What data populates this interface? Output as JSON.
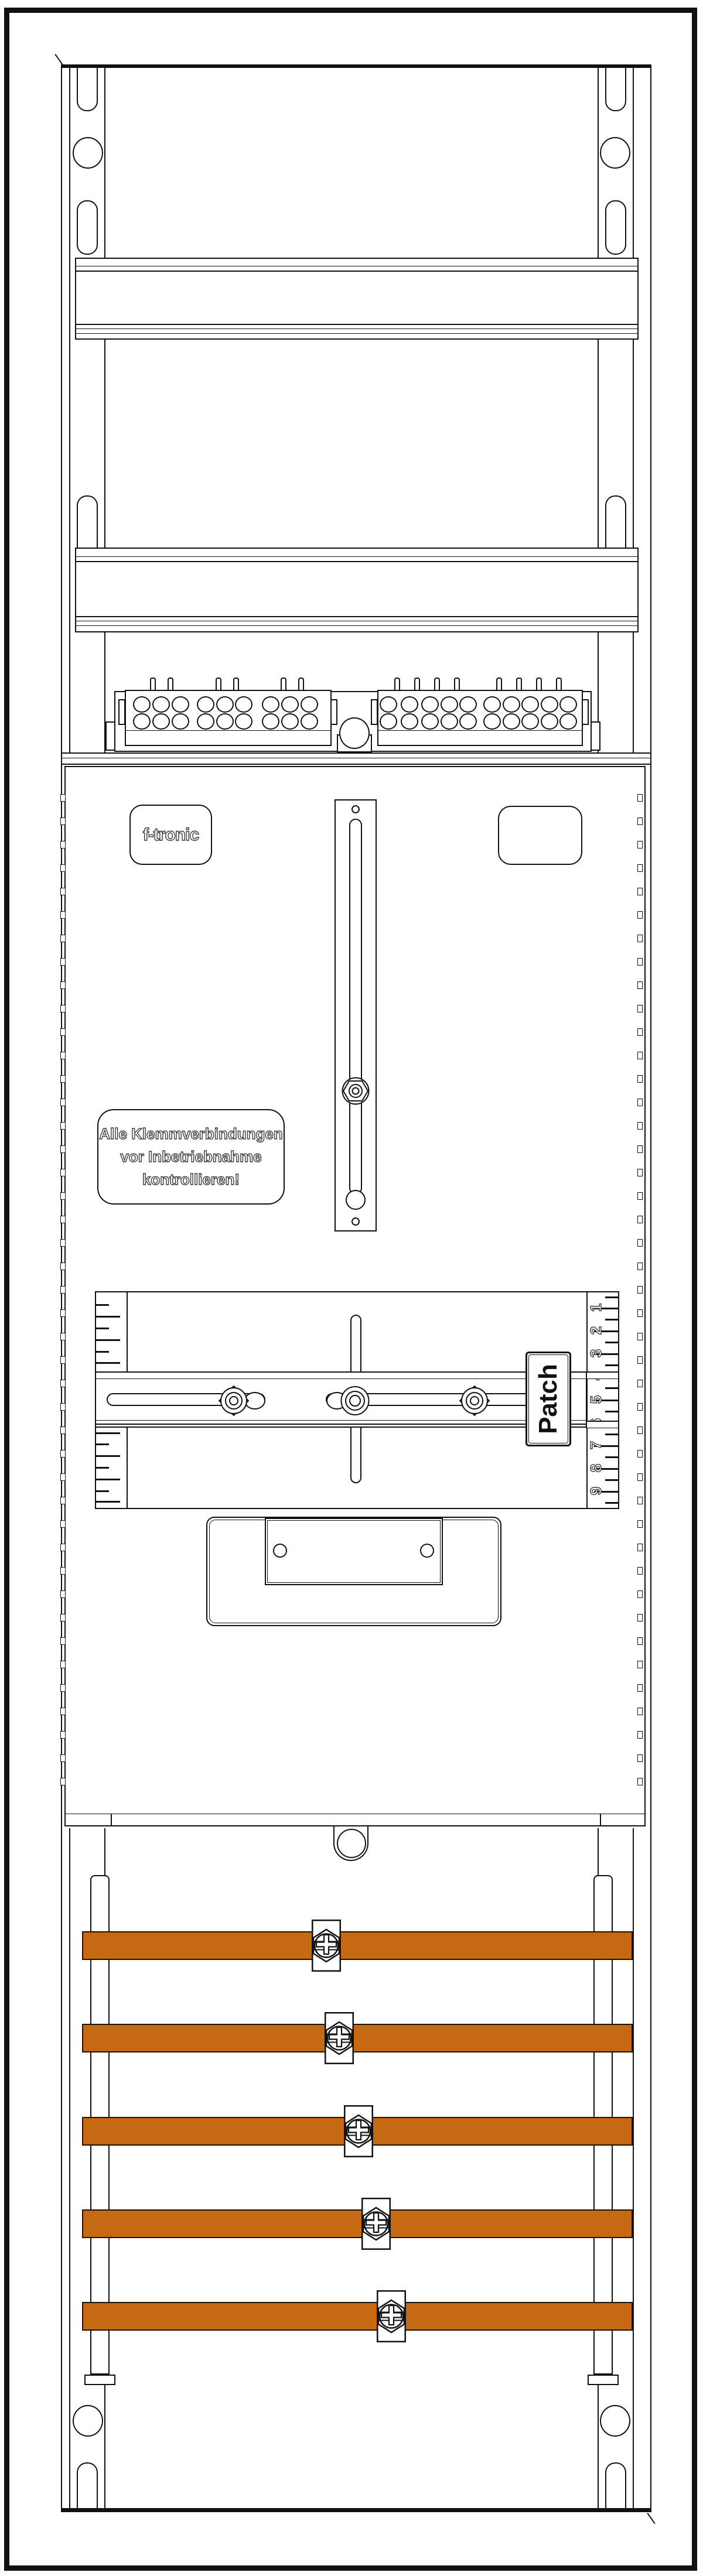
{
  "colors": {
    "background": "#ffffff",
    "line": "#111111",
    "busbar_fill": "#c56a12",
    "busbar_edge": "#211102",
    "text_outline": "#3c3c3c",
    "patch_text": "#111111"
  },
  "logo": {
    "text": "f-tronic"
  },
  "warning_label": {
    "line1": "Alle Klemmverbindungen",
    "line2": "vor Inbetriebnahme",
    "line3": "kontrollieren!"
  },
  "patch_label": {
    "text": "Patch"
  },
  "side_scale": {
    "numbers": [
      "1",
      "2",
      "3",
      "4",
      "5",
      "6",
      "7",
      "8",
      "9"
    ]
  },
  "terminals": {
    "left_block": {
      "rows": 2,
      "columns": 9,
      "groups": 3
    },
    "right_block": {
      "rows": 2,
      "columns": 10,
      "groups": 2
    }
  },
  "busbars": {
    "count": 5,
    "clamp_type": "phillips-screw-clamp"
  }
}
